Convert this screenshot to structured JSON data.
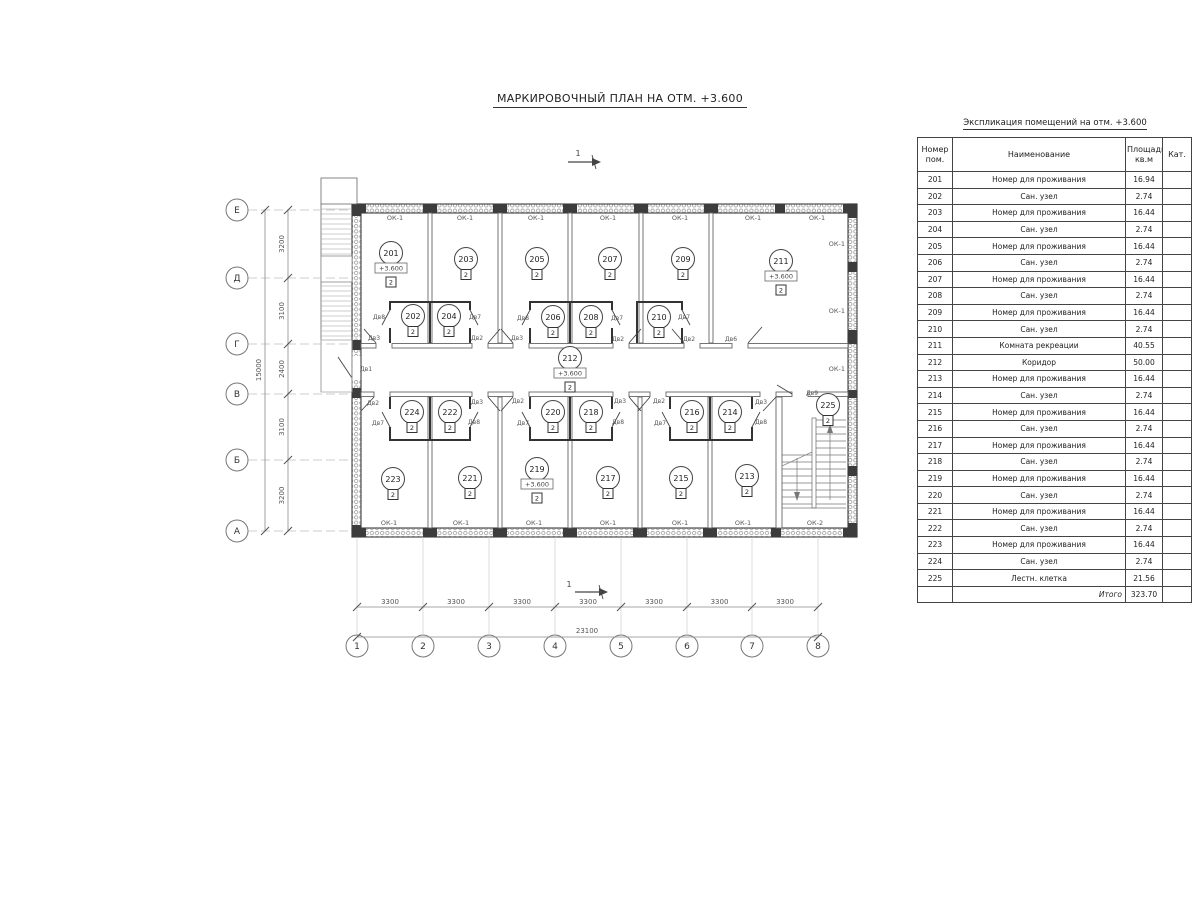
{
  "page": {
    "title": "МАРКИРОВОЧНЫЙ ПЛАН НА ОТМ. +3.600"
  },
  "table": {
    "title": "Экспликация помещений на отм. +3.600",
    "headers": {
      "number": "Номер пом.",
      "name": "Наименование",
      "area": "Площадь кв.м",
      "cat": "Кат."
    },
    "rows": [
      [
        "201",
        "Номер для проживания",
        "16.94"
      ],
      [
        "202",
        "Сан. узел",
        "2.74"
      ],
      [
        "203",
        "Номер для проживания",
        "16.44"
      ],
      [
        "204",
        "Сан. узел",
        "2.74"
      ],
      [
        "205",
        "Номер для проживания",
        "16.44"
      ],
      [
        "206",
        "Сан. узел",
        "2.74"
      ],
      [
        "207",
        "Номер для проживания",
        "16.44"
      ],
      [
        "208",
        "Сан. узел",
        "2.74"
      ],
      [
        "209",
        "Номер для проживания",
        "16.44"
      ],
      [
        "210",
        "Сан. узел",
        "2.74"
      ],
      [
        "211",
        "Комната рекреации",
        "40.55"
      ],
      [
        "212",
        "Коридор",
        "50.00"
      ],
      [
        "213",
        "Номер для проживания",
        "16.44"
      ],
      [
        "214",
        "Сан. узел",
        "2.74"
      ],
      [
        "215",
        "Номер для проживания",
        "16.44"
      ],
      [
        "216",
        "Сан. узел",
        "2.74"
      ],
      [
        "217",
        "Номер для проживания",
        "16.44"
      ],
      [
        "218",
        "Сан. узел",
        "2.74"
      ],
      [
        "219",
        "Номер для проживания",
        "16.44"
      ],
      [
        "220",
        "Сан. узел",
        "2.74"
      ],
      [
        "221",
        "Номер для проживания",
        "16.44"
      ],
      [
        "222",
        "Сан. узел",
        "2.74"
      ],
      [
        "223",
        "Номер для проживания",
        "16.44"
      ],
      [
        "224",
        "Сан. узел",
        "2.74"
      ],
      [
        "225",
        "Лестн. клетка",
        "21.56"
      ]
    ],
    "total_label": "Итого",
    "total_value": "323.70"
  },
  "plan": {
    "section_label": "1",
    "section_marks": [
      {
        "x": 578,
        "y": 156
      },
      {
        "x": 569,
        "y": 587
      }
    ],
    "axes_left": [
      {
        "label": "Е",
        "y": 210
      },
      {
        "label": "Д",
        "y": 278
      },
      {
        "label": "Г",
        "y": 344
      },
      {
        "label": "В",
        "y": 394
      },
      {
        "label": "Б",
        "y": 460
      },
      {
        "label": "А",
        "y": 531
      }
    ],
    "axes_bottom": [
      {
        "label": "1",
        "x": 357
      },
      {
        "label": "2",
        "x": 423
      },
      {
        "label": "3",
        "x": 489
      },
      {
        "label": "4",
        "x": 555
      },
      {
        "label": "5",
        "x": 621
      },
      {
        "label": "6",
        "x": 687
      },
      {
        "label": "7",
        "x": 752
      },
      {
        "label": "8",
        "x": 818
      }
    ],
    "dims_left_segments": [
      {
        "text": "3200",
        "y1": 210,
        "y2": 278
      },
      {
        "text": "3100",
        "y1": 278,
        "y2": 344
      },
      {
        "text": "2400",
        "y1": 344,
        "y2": 394
      },
      {
        "text": "3100",
        "y1": 394,
        "y2": 460
      },
      {
        "text": "3200",
        "y1": 460,
        "y2": 531
      }
    ],
    "dim_left_total": "15000",
    "dims_bottom_segments": [
      {
        "text": "3300",
        "x1": 357,
        "x2": 423
      },
      {
        "text": "3300",
        "x1": 423,
        "x2": 489
      },
      {
        "text": "3300",
        "x1": 489,
        "x2": 555
      },
      {
        "text": "3300",
        "x1": 555,
        "x2": 621
      },
      {
        "text": "3300",
        "x1": 621,
        "x2": 687
      },
      {
        "text": "3300",
        "x1": 687,
        "x2": 752
      },
      {
        "text": "3300",
        "x1": 752,
        "x2": 818
      }
    ],
    "dim_bottom_total": "23100",
    "rooms": [
      {
        "number": "201",
        "x": 391,
        "y": 253,
        "elev": "+3.600",
        "cat": "2"
      },
      {
        "number": "203",
        "x": 466,
        "y": 259,
        "cat": "2"
      },
      {
        "number": "205",
        "x": 537,
        "y": 259,
        "cat": "2"
      },
      {
        "number": "207",
        "x": 610,
        "y": 259,
        "cat": "2"
      },
      {
        "number": "209",
        "x": 683,
        "y": 259,
        "cat": "2"
      },
      {
        "number": "211",
        "x": 781,
        "y": 261,
        "elev": "+3.600",
        "cat": "2"
      },
      {
        "number": "202",
        "x": 413,
        "y": 316,
        "cat": "2"
      },
      {
        "number": "204",
        "x": 449,
        "y": 316,
        "cat": "2"
      },
      {
        "number": "206",
        "x": 553,
        "y": 317,
        "cat": "2"
      },
      {
        "number": "208",
        "x": 591,
        "y": 317,
        "cat": "2"
      },
      {
        "number": "210",
        "x": 659,
        "y": 317,
        "cat": "2"
      },
      {
        "number": "212",
        "x": 570,
        "y": 358,
        "elev": "+3.600",
        "cat": "2"
      },
      {
        "number": "224",
        "x": 412,
        "y": 412,
        "cat": "2"
      },
      {
        "number": "222",
        "x": 450,
        "y": 412,
        "cat": "2"
      },
      {
        "number": "220",
        "x": 553,
        "y": 412,
        "cat": "2"
      },
      {
        "number": "218",
        "x": 591,
        "y": 412,
        "cat": "2"
      },
      {
        "number": "216",
        "x": 692,
        "y": 412,
        "cat": "2"
      },
      {
        "number": "214",
        "x": 730,
        "y": 412,
        "cat": "2"
      },
      {
        "number": "223",
        "x": 393,
        "y": 479,
        "cat": "2"
      },
      {
        "number": "221",
        "x": 470,
        "y": 478,
        "cat": "2"
      },
      {
        "number": "219",
        "x": 537,
        "y": 469,
        "elev": "+3.600",
        "cat": "2"
      },
      {
        "number": "217",
        "x": 608,
        "y": 478,
        "cat": "2"
      },
      {
        "number": "215",
        "x": 681,
        "y": 478,
        "cat": "2"
      },
      {
        "number": "213",
        "x": 747,
        "y": 476,
        "cat": "2"
      },
      {
        "number": "225",
        "x": 828,
        "y": 405,
        "cat": "2"
      }
    ],
    "window_labels": [
      {
        "text": "ОК-1",
        "x": 395,
        "y": 220
      },
      {
        "text": "ОК-1",
        "x": 465,
        "y": 220
      },
      {
        "text": "ОК-1",
        "x": 536,
        "y": 220
      },
      {
        "text": "ОК-1",
        "x": 608,
        "y": 220
      },
      {
        "text": "ОК-1",
        "x": 680,
        "y": 220
      },
      {
        "text": "ОК-1",
        "x": 753,
        "y": 220
      },
      {
        "text": "ОК-1",
        "x": 817,
        "y": 220
      },
      {
        "text": "ОК-1",
        "x": 389,
        "y": 525
      },
      {
        "text": "ОК-1",
        "x": 461,
        "y": 525
      },
      {
        "text": "ОК-1",
        "x": 534,
        "y": 525
      },
      {
        "text": "ОК-1",
        "x": 608,
        "y": 525
      },
      {
        "text": "ОК-1",
        "x": 680,
        "y": 525
      },
      {
        "text": "ОК-1",
        "x": 743,
        "y": 525
      },
      {
        "text": "ОК-2",
        "x": 815,
        "y": 525
      },
      {
        "text": "ОК-1",
        "x": 845,
        "y": 246,
        "anchor": "end"
      },
      {
        "text": "ОК-1",
        "x": 845,
        "y": 313,
        "anchor": "end"
      },
      {
        "text": "ОК-1",
        "x": 845,
        "y": 371,
        "anchor": "end"
      }
    ],
    "door_labels": [
      {
        "text": "Дв1",
        "x": 366,
        "y": 371
      },
      {
        "text": "Дв3",
        "x": 374,
        "y": 340
      },
      {
        "text": "Дв2",
        "x": 477,
        "y": 340
      },
      {
        "text": "Дв3",
        "x": 517,
        "y": 340
      },
      {
        "text": "Дв2",
        "x": 618,
        "y": 341
      },
      {
        "text": "Дв2",
        "x": 689,
        "y": 341
      },
      {
        "text": "Дв6",
        "x": 731,
        "y": 341
      },
      {
        "text": "Дв8",
        "x": 379,
        "y": 319
      },
      {
        "text": "Дв7",
        "x": 475,
        "y": 319
      },
      {
        "text": "Дв8",
        "x": 523,
        "y": 320
      },
      {
        "text": "Дв7",
        "x": 617,
        "y": 320
      },
      {
        "text": "Дв7",
        "x": 684,
        "y": 319
      },
      {
        "text": "Дв2",
        "x": 373,
        "y": 405
      },
      {
        "text": "Дв3",
        "x": 477,
        "y": 404
      },
      {
        "text": "Дв2",
        "x": 518,
        "y": 403
      },
      {
        "text": "Дв3",
        "x": 620,
        "y": 403
      },
      {
        "text": "Дв2",
        "x": 659,
        "y": 403
      },
      {
        "text": "Дв3",
        "x": 761,
        "y": 404
      },
      {
        "text": "Дв9",
        "x": 812,
        "y": 395
      },
      {
        "text": "Дв7",
        "x": 378,
        "y": 425
      },
      {
        "text": "Дв8",
        "x": 474,
        "y": 424
      },
      {
        "text": "Дв7",
        "x": 523,
        "y": 425
      },
      {
        "text": "Дв8",
        "x": 618,
        "y": 424
      },
      {
        "text": "Дв7",
        "x": 660,
        "y": 425
      },
      {
        "text": "Дв8",
        "x": 761,
        "y": 424
      }
    ]
  }
}
